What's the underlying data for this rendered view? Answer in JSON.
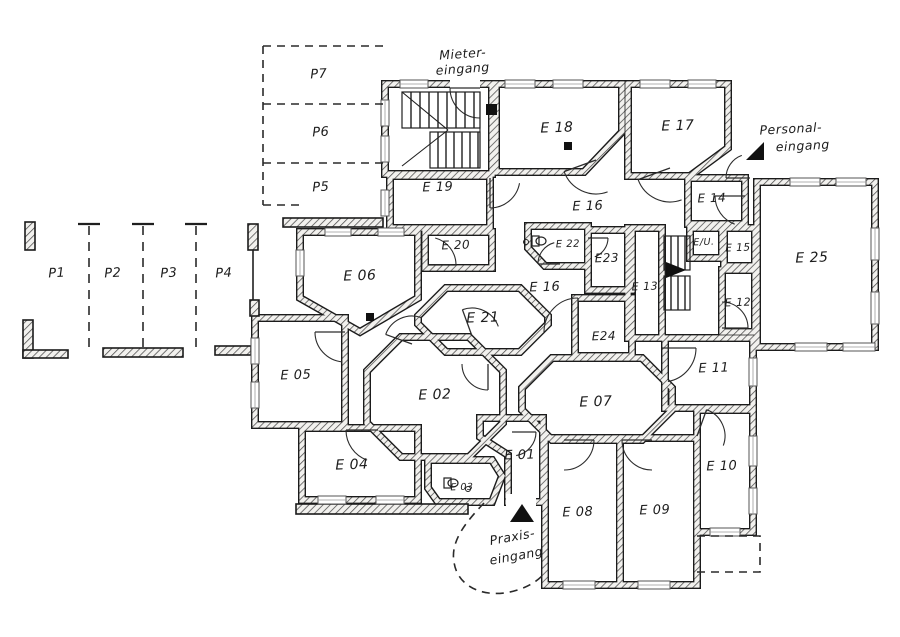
{
  "title": "Hand-drawn ground-floor plan with rooms E01-E25, parking P1-P7 and three entrances",
  "colors": {
    "ink": "#1f1f1f",
    "wall": "#1b1b1b",
    "paper": "#ffffff",
    "hatch": "#4a4a4a"
  },
  "rooms": [
    {
      "id": "stairwell-main",
      "label": "",
      "lx": 0,
      "ly": 0,
      "fs": 12,
      "poly": "385,84 492,84 492,174 385,174"
    },
    {
      "id": "E18",
      "label": "E 18",
      "lx": 557,
      "ly": 132,
      "fs": 14,
      "poly": "496,84 622,84 622,132 584,172 496,172"
    },
    {
      "id": "E17",
      "label": "E 17",
      "lx": 678,
      "ly": 130,
      "fs": 14,
      "poly": "628,84 728,84 728,148 690,176 628,176"
    },
    {
      "id": "E19",
      "label": "E 19",
      "lx": 438,
      "ly": 191,
      "fs": 13,
      "poly": "390,176 490,176 490,228 390,228"
    },
    {
      "id": "E14",
      "label": "E 14",
      "lx": 712,
      "ly": 202,
      "fs": 12,
      "poly": "688,178 745,178 745,224 688,224"
    },
    {
      "id": "E25",
      "label": "E 25",
      "lx": 812,
      "ly": 262,
      "fs": 14,
      "poly": "757,182 875,182 875,347 757,347"
    },
    {
      "id": "E20",
      "label": "E 20",
      "lx": 456,
      "ly": 249,
      "fs": 12,
      "poly": "425,232 492,232 492,268 425,268"
    },
    {
      "id": "E22",
      "label": "E 22",
      "lx": 568,
      "ly": 247,
      "fs": 10,
      "poly": "528,226 588,226 588,266 545,266 528,248"
    },
    {
      "id": "E23",
      "label": "E23",
      "lx": 607,
      "ly": 262,
      "fs": 12,
      "poly": "588,230 632,230 632,290 588,290"
    },
    {
      "id": "EU",
      "label": "E/U.",
      "lx": 704,
      "ly": 245,
      "fs": 9.5,
      "poly": "690,228 722,228 722,258 690,258"
    },
    {
      "id": "E15",
      "label": "E 15",
      "lx": 738,
      "ly": 251,
      "fs": 10.5,
      "poly": "724,228 755,228 755,266 724,266"
    },
    {
      "id": "E13",
      "label": "E 13",
      "lx": 645,
      "ly": 290,
      "fs": 11,
      "poly": "628,228 662,228 662,338 628,338"
    },
    {
      "id": "E12",
      "label": "E 12",
      "lx": 738,
      "ly": 306,
      "fs": 11,
      "poly": "722,270 755,270 755,332 722,332"
    },
    {
      "id": "E06",
      "label": "E 06",
      "lx": 360,
      "ly": 280,
      "fs": 14,
      "poly": "300,232 418,232 418,298 360,332 300,298"
    },
    {
      "id": "E21",
      "label": "E 21",
      "lx": 483,
      "ly": 322,
      "fs": 14,
      "poly": "446,288 520,288 548,316 548,324 520,352 446,352 418,324 418,316"
    },
    {
      "id": "E24",
      "label": "E24",
      "lx": 604,
      "ly": 340,
      "fs": 12,
      "poly": "575,298 632,298 632,356 575,356"
    },
    {
      "id": "E05",
      "label": "E 05",
      "lx": 296,
      "ly": 379,
      "fs": 13,
      "poly": "255,318 345,318 345,425 255,425"
    },
    {
      "id": "E02",
      "label": "E 02",
      "lx": 435,
      "ly": 399,
      "fs": 14,
      "poly": "401,337 469,337 503,371 503,423 469,457 401,457 367,423 367,371"
    },
    {
      "id": "E11",
      "label": "E 11",
      "lx": 714,
      "ly": 372,
      "fs": 13,
      "poly": "665,338 753,338 753,408 665,408"
    },
    {
      "id": "E07",
      "label": "E 07",
      "lx": 596,
      "ly": 406,
      "fs": 14,
      "poly": "552,358 642,358 672,388 672,410 642,440 552,440 522,410 522,388"
    },
    {
      "id": "E04",
      "label": "E 04",
      "lx": 352,
      "ly": 469,
      "fs": 14,
      "poly": "302,428 418,428 418,500 302,500"
    },
    {
      "id": "E03",
      "label": "E 03",
      "lx": 462,
      "ly": 490,
      "fs": 9.5,
      "poly": "428,460 492,460 502,476 492,502 438,502 428,488"
    },
    {
      "id": "E01",
      "label": "E 01",
      "lx": 520,
      "ly": 459,
      "fs": 13,
      "poly": "480,418 543,418 543,502 508,502 508,455 480,437"
    },
    {
      "id": "E08",
      "label": "E 08",
      "lx": 578,
      "ly": 516,
      "fs": 13,
      "poly": "545,438 620,438 620,585 545,585"
    },
    {
      "id": "E09",
      "label": "E 09",
      "lx": 655,
      "ly": 514,
      "fs": 13,
      "poly": "620,438 697,438 697,585 620,585"
    },
    {
      "id": "E10",
      "label": "E 10",
      "lx": 722,
      "ly": 470,
      "fs": 13,
      "poly": "697,410 753,410 753,532 697,532"
    }
  ],
  "corridor_labels": [
    {
      "t": "E 16",
      "x": 588,
      "y": 210,
      "fs": 13
    },
    {
      "t": "E 16",
      "x": 545,
      "y": 291,
      "fs": 13
    }
  ],
  "parking": {
    "left_labels": [
      {
        "t": "P1",
        "x": 57,
        "y": 277
      },
      {
        "t": "P2",
        "x": 113,
        "y": 277
      },
      {
        "t": "P3",
        "x": 169,
        "y": 277
      },
      {
        "t": "P4",
        "x": 224,
        "y": 277
      }
    ],
    "left_dividers": [
      89,
      143,
      196
    ],
    "top_labels": [
      {
        "t": "P7",
        "x": 319,
        "y": 78
      },
      {
        "t": "P6",
        "x": 321,
        "y": 136
      },
      {
        "t": "P5",
        "x": 321,
        "y": 191
      }
    ]
  },
  "entrances": [
    {
      "id": "mieter",
      "lines": [
        {
          "t": "Mieter-",
          "x": 463,
          "y": 58
        },
        {
          "t": "eingang",
          "x": 463,
          "y": 73
        }
      ],
      "rot": -4
    },
    {
      "id": "personal",
      "lines": [
        {
          "t": "Personal-",
          "x": 791,
          "y": 133
        },
        {
          "t": "eingang",
          "x": 803,
          "y": 150
        }
      ],
      "rot": -3
    },
    {
      "id": "praxis",
      "lines": [
        {
          "t": "Praxis-",
          "x": 513,
          "y": 541
        },
        {
          "t": "eingang",
          "x": 517,
          "y": 560
        }
      ],
      "rot": -10
    }
  ],
  "triangles": [
    {
      "id": "personal-arrow",
      "pts": "746,160 764,142 764,160"
    },
    {
      "id": "praxis-arrow",
      "pts": "522,504 510,522 534,522"
    },
    {
      "id": "stair-direction",
      "pts": "666,262 686,270 666,278"
    }
  ],
  "squares": [
    [
      486,
      104,
      11,
      11
    ],
    [
      564,
      142,
      8,
      8
    ],
    [
      366,
      313,
      8,
      8
    ]
  ],
  "stairs": [
    {
      "box": [
        402,
        92,
        78,
        36
      ],
      "step": 9
    },
    {
      "box": [
        430,
        132,
        50,
        36
      ],
      "step": 8
    },
    {
      "box": [
        664,
        236,
        26,
        34
      ],
      "step": 7
    },
    {
      "box": [
        664,
        276,
        26,
        34
      ],
      "step": 7
    }
  ],
  "stair_aux_lines": [
    [
      402,
      92,
      448,
      130
    ],
    [
      402,
      166,
      448,
      130
    ],
    [
      480,
      92,
      480,
      168
    ]
  ],
  "doors": [
    {
      "h": [
        480,
        88
      ],
      "r": 30,
      "a0": 180,
      "a1": 90,
      "sw": 0
    },
    {
      "h": [
        596,
        160
      ],
      "r": 34,
      "a0": 160,
      "a1": 70,
      "sw": 0
    },
    {
      "h": [
        670,
        168
      ],
      "r": 34,
      "a0": 160,
      "a1": 70,
      "sw": 0
    },
    {
      "h": [
        490,
        178
      ],
      "r": 30,
      "a0": 90,
      "a1": 10,
      "sw": 0
    },
    {
      "h": [
        428,
        265
      ],
      "r": 28,
      "a0": 0,
      "a1": -75,
      "sw": 0
    },
    {
      "h": [
        745,
        196
      ],
      "r": 30,
      "a0": 180,
      "a1": 110,
      "sw": 0
    },
    {
      "h": [
        560,
        264
      ],
      "r": 22,
      "a0": 180,
      "a1": 255,
      "sw": 1
    },
    {
      "h": [
        578,
        332
      ],
      "r": 34,
      "a0": 270,
      "a1": 180,
      "sw": 0
    },
    {
      "h": [
        722,
        328
      ],
      "r": 26,
      "a0": 0,
      "a1": -90,
      "sw": 0
    },
    {
      "h": [
        662,
        348
      ],
      "r": 34,
      "a0": 0,
      "a1": 80,
      "sw": 1
    },
    {
      "h": [
        412,
        344
      ],
      "r": 28,
      "a0": 200,
      "a1": 290,
      "sw": 1
    },
    {
      "h": [
        472,
        336
      ],
      "r": 28,
      "a0": 250,
      "a1": 340,
      "sw": 1
    },
    {
      "h": [
        345,
        332
      ],
      "r": 30,
      "a0": 180,
      "a1": 95,
      "sw": 0
    },
    {
      "h": [
        488,
        364
      ],
      "r": 26,
      "a0": 90,
      "a1": 180,
      "sw": 1
    },
    {
      "h": [
        378,
        430
      ],
      "r": 32,
      "a0": 180,
      "a1": 110,
      "sw": 0
    },
    {
      "h": [
        512,
        432
      ],
      "r": 24,
      "a0": 0,
      "a1": 80,
      "sw": 1
    },
    {
      "h": [
        564,
        440
      ],
      "r": 30,
      "a0": 0,
      "a1": 90,
      "sw": 1
    },
    {
      "h": [
        652,
        440
      ],
      "r": 30,
      "a0": 180,
      "a1": 90,
      "sw": 0
    },
    {
      "h": [
        697,
        436
      ],
      "r": 28,
      "a0": -70,
      "a1": 20,
      "sw": 1
    },
    {
      "h": [
        750,
        178
      ],
      "r": 24,
      "a0": 180,
      "a1": 250,
      "sw": 1
    },
    {
      "h": [
        588,
        238
      ],
      "r": 20,
      "a0": 0,
      "a1": 70,
      "sw": 1
    }
  ],
  "windows": [
    [
      400,
      80,
      28,
      8
    ],
    [
      505,
      80,
      30,
      8
    ],
    [
      553,
      80,
      30,
      8
    ],
    [
      640,
      80,
      30,
      8
    ],
    [
      688,
      80,
      28,
      8
    ],
    [
      381,
      100,
      8,
      26
    ],
    [
      381,
      136,
      8,
      26
    ],
    [
      381,
      190,
      8,
      26
    ],
    [
      325,
      228,
      26,
      8
    ],
    [
      378,
      228,
      26,
      8
    ],
    [
      296,
      250,
      8,
      26
    ],
    [
      251,
      338,
      8,
      26
    ],
    [
      251,
      382,
      8,
      26
    ],
    [
      318,
      496,
      28,
      8
    ],
    [
      376,
      496,
      28,
      8
    ],
    [
      563,
      581,
      32,
      8
    ],
    [
      638,
      581,
      32,
      8
    ],
    [
      710,
      528,
      30,
      8
    ],
    [
      749,
      436,
      8,
      30
    ],
    [
      749,
      488,
      8,
      26
    ],
    [
      749,
      358,
      8,
      28
    ],
    [
      790,
      178,
      30,
      8
    ],
    [
      836,
      178,
      30,
      8
    ],
    [
      871,
      228,
      8,
      32
    ],
    [
      871,
      292,
      8,
      32
    ],
    [
      795,
      343,
      32,
      8
    ],
    [
      843,
      343,
      32,
      8
    ]
  ],
  "door_gaps": [
    {
      "r": [
        450,
        78,
        30,
        14
      ]
    },
    {
      "r": [
        730,
        150,
        30,
        16
      ],
      "rot": [
        42,
        745,
        158
      ]
    },
    {
      "r": [
        506,
        494,
        30,
        16
      ]
    }
  ],
  "garden_walls": [
    [
      25,
      222,
      10,
      28
    ],
    [
      23,
      320,
      10,
      38
    ],
    [
      23,
      350,
      45,
      8
    ],
    [
      103,
      348,
      80,
      9
    ],
    [
      215,
      346,
      36,
      9
    ],
    [
      248,
      224,
      10,
      26
    ],
    [
      250,
      300,
      9,
      16
    ],
    [
      283,
      218,
      100,
      9
    ],
    [
      296,
      504,
      172,
      10
    ]
  ],
  "solid_thin_lines": [
    [
      253,
      250,
      253,
      300
    ]
  ],
  "dashed_paths": [
    "M263,46 H383",
    "M263,104 H383",
    "M263,163 H383",
    "M263,46 V205",
    "M263,205 H300",
    "M484,503 C468,520 450,540 454,562 C457,584 478,596 504,593 C520,591 534,584 542,576",
    "M697,536 H760 V572 H697"
  ],
  "wc_fixtures": [
    {
      "bowl": [
        541,
        241,
        5,
        4
      ],
      "tank": [
        532,
        236,
        7,
        10
      ],
      "dot": [
        526,
        242
      ]
    },
    {
      "bowl": [
        453,
        483,
        5,
        4
      ],
      "tank": [
        444,
        478,
        7,
        10
      ],
      "dot": [
        468,
        489
      ]
    }
  ]
}
